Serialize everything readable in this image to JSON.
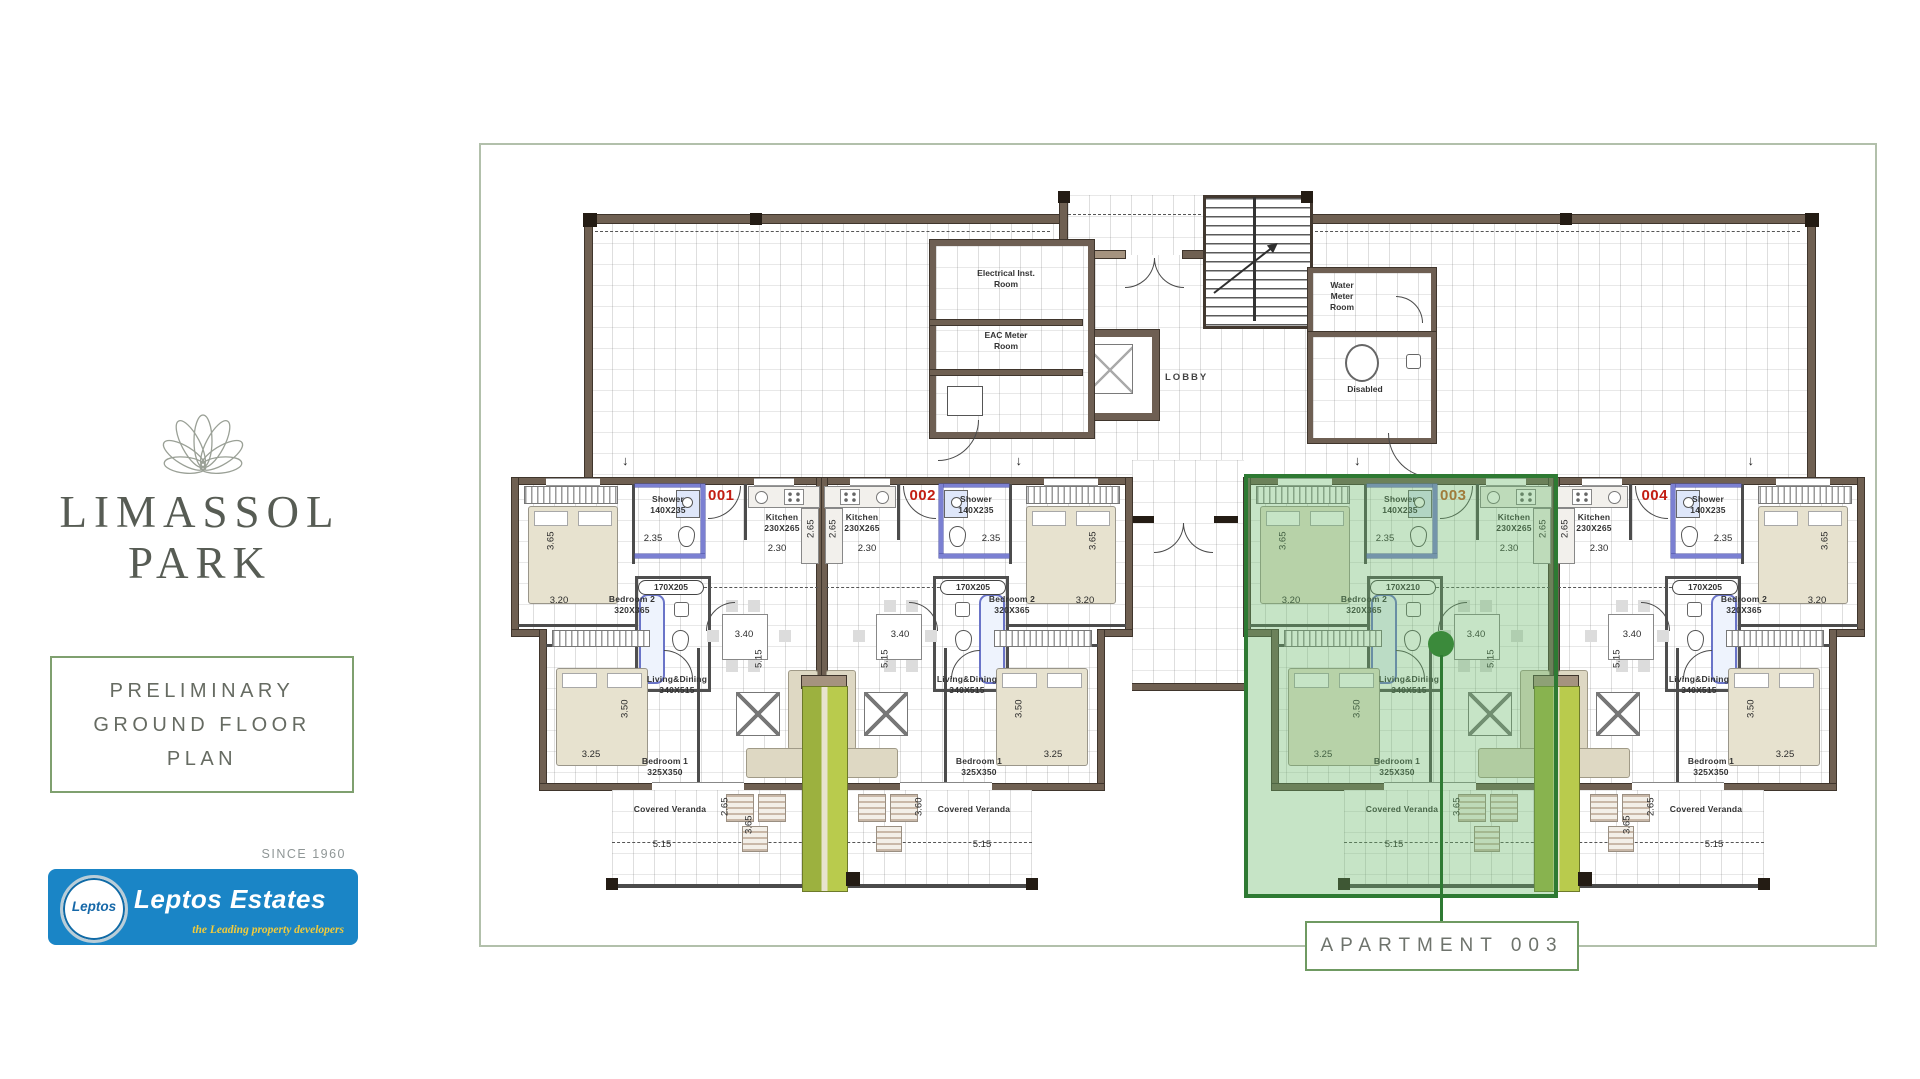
{
  "sidebar": {
    "brand": "LIMASSOL\nPARK",
    "plan_title": "PRELIMINARY\nGROUND FLOOR\nPLAN",
    "since_label": "SINCE 1960",
    "logo_badge": "Leptos",
    "logo_name": "Leptos Estates",
    "logo_tagline": "the Leading property developers"
  },
  "plan": {
    "callout_label": "APARTMENT 003",
    "entry_arrow": "↓",
    "core": {
      "electrical_room": "Electrical Inst.\nRoom",
      "eac_room": "EAC Meter\nRoom",
      "lobby": "LOBBY",
      "water_room": "Water\nMeter\nRoom",
      "disabled": "Disabled"
    },
    "rooms": {
      "bedroom1": "Bedroom 1\n325X350",
      "bedroom2": "Bedroom 2\n320X365",
      "kitchen": "Kitchen\n230X265",
      "living": "Living&Dining\n340X515",
      "shower": "Shower\n140X235",
      "veranda": "Covered Veranda"
    },
    "dims": {
      "bed2_w": "3.65",
      "bed2_l": "3.20",
      "bed1_w": "3.50",
      "bed1_l": "3.25",
      "table": "3.40",
      "living_l": "5.15",
      "kit_w": "2.30",
      "kit_d": "2.65",
      "shower_d": "2.35",
      "ver_l": "5.15"
    },
    "apartments": [
      {
        "number": "001",
        "bath": "170X205",
        "veranda_dims": [
          "2.65",
          "3.65"
        ]
      },
      {
        "number": "002",
        "bath": "170X205",
        "veranda_dims": [
          "3.60",
          ""
        ]
      },
      {
        "number": "003",
        "bath": "170X210",
        "veranda_dims": [
          "3.65",
          ""
        ],
        "highlighted": true
      },
      {
        "number": "004",
        "bath": "170X205",
        "veranda_dims": [
          "2.65",
          "3.65"
        ]
      }
    ],
    "colors": {
      "highlight_green": "#6ab96a",
      "highlight_wall": "#2e7a33",
      "unit_number_red": "#c21d12",
      "unit_number_highlighted": "#c2571f",
      "wall_brown": "#6f6052",
      "planter_lime": "#b9cb4d",
      "callout_border": "#6f9a62",
      "frame_border": "#b2c0ab",
      "logo_blue": "#1a85c6",
      "tagline_yellow": "#f2cb3b"
    }
  }
}
